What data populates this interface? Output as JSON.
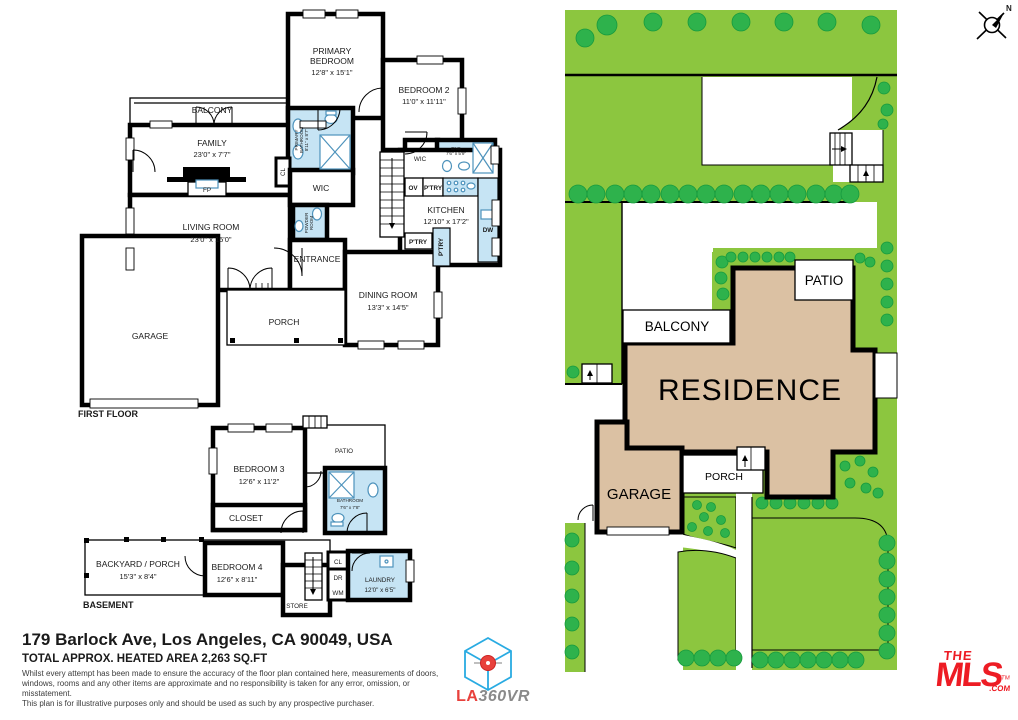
{
  "colors": {
    "lawn": "#8CC63F",
    "tree": "#2EB24C",
    "tree_stroke": "#179A3E",
    "residence": "#DBC1A3",
    "wet": "#C6E4F4",
    "fixture": "#4E93BC",
    "wall": "#000000",
    "mls_red": "#ED1C24",
    "cube_blue": "#29ABE2",
    "la_red": "#E8413C",
    "vr_gray": "#8A8A8A"
  },
  "first_floor": {
    "label": "FIRST FLOOR",
    "balcony": "BALCONY",
    "family": {
      "name": "FAMILY",
      "dims": "23'0\" x 7'7\""
    },
    "primary_bedroom": {
      "l1": "PRIMARY",
      "l2": "BEDROOM",
      "dims": "12'8\" x 15'1\""
    },
    "bedroom2": {
      "name": "BEDROOM 2",
      "dims": "11'0\" x 11'11\""
    },
    "primary_bathroom": {
      "l1": "PRIMARY",
      "l2": "BATHROOM",
      "dims": "8'11\" x 8'7\""
    },
    "cl": "CL",
    "wic": "WIC",
    "powder": {
      "l1": "POWDER",
      "l2": "ROOM"
    },
    "ens": {
      "name": "ENS",
      "dims": "7'6\" x 5'9\""
    },
    "ov": "OV",
    "ptry": "P'TRY",
    "kitchen": {
      "name": "KITCHEN",
      "dims": "12'10\" x 17'2\""
    },
    "dw": "DW",
    "fp": "FP",
    "living": {
      "name": "LIVING ROOM",
      "dims": "23'0\" x 15'0\""
    },
    "entrance": "ENTRANCE",
    "dining": {
      "name": "DINING ROOM",
      "dims": "13'3\" x 14'5\""
    },
    "porch": "PORCH",
    "garage": "GARAGE"
  },
  "basement": {
    "label": "BASEMENT",
    "bedroom3": {
      "name": "BEDROOM 3",
      "dims": "12'6\" x 11'2\""
    },
    "patio": "PATIO",
    "bathroom": {
      "name": "BATHROOM",
      "dims": "7'6\" x 7'8\""
    },
    "closet": "CLOSET",
    "backyard": {
      "name": "BACKYARD / PORCH",
      "dims": "15'3\" x 8'4\""
    },
    "bedroom4": {
      "name": "BEDROOM 4",
      "dims": "12'6\" x 8'11\""
    },
    "store": "STORE",
    "cl": "CL",
    "dr": "DR",
    "wm": "WM",
    "laundry": {
      "name": "LAUNDRY",
      "dims": "12'0\" x 6'5\""
    }
  },
  "site_plan": {
    "residence": "RESIDENCE",
    "balcony": "BALCONY",
    "patio": "PATIO",
    "garage": "GARAGE",
    "porch": "PORCH"
  },
  "compass": {
    "north": "N"
  },
  "footer": {
    "address": "179 Barlock Ave, Los Angeles, CA 90049, USA",
    "area": "TOTAL APPROX. HEATED AREA 2,263 SQ.FT",
    "disclaimer": [
      "Whilst every attempt has been made to ensure the accuracy of the floor plan contained here, measurements of doors,",
      "windows, rooms and any other items are approximate and no responsibility is taken for any error, omission, or misstatement.",
      "This plan is for illustrative purposes only and should be used as such by any prospective purchaser."
    ]
  },
  "logos": {
    "la360vr": {
      "la": "LA",
      "rest": "360VR"
    },
    "mls": {
      "the": "THE",
      "mls": "MLS",
      "com": ".COM",
      "tm": "TM"
    }
  }
}
